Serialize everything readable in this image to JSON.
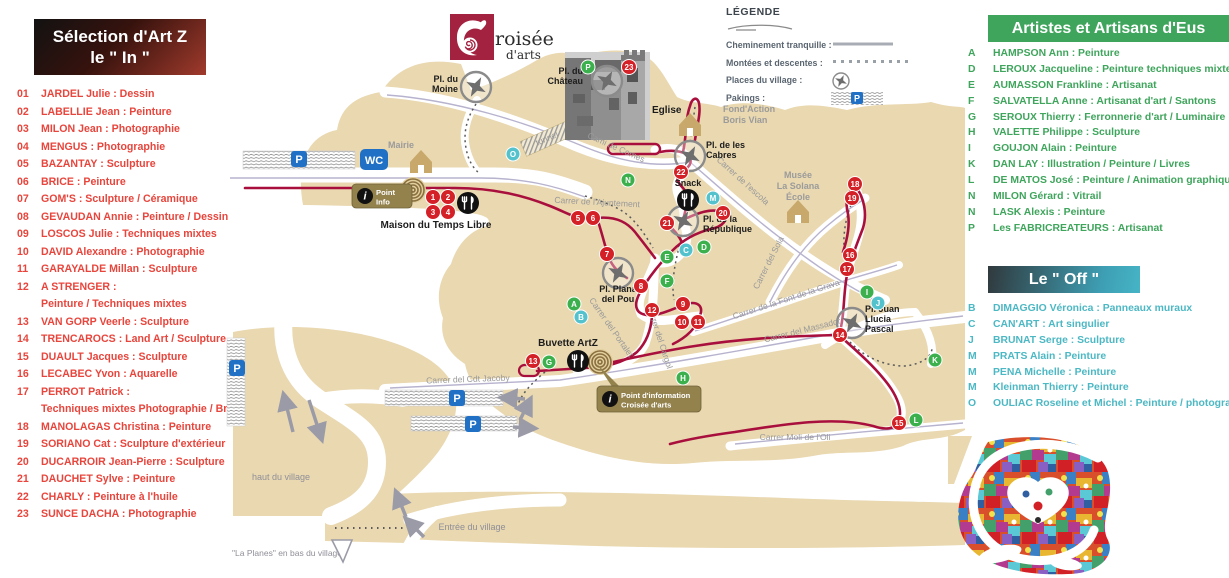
{
  "left_panel": {
    "title_line1": "Sélection d'Art Z",
    "title_line2": "le \" In \"",
    "items": [
      {
        "num": "01",
        "text": "JARDEL Julie : Dessin"
      },
      {
        "num": "02",
        "text": "LABELLIE Jean : Peinture"
      },
      {
        "num": "03",
        "text": "MILON Jean : Photographie"
      },
      {
        "num": "04",
        "text": "MENGUS :  Photographie"
      },
      {
        "num": "05",
        "text": "BAZANTAY : Sculpture"
      },
      {
        "num": "06",
        "text": "BRICE : Peinture"
      },
      {
        "num": "07",
        "text": "GOM'S : Sculpture / Céramique"
      },
      {
        "num": "08",
        "text": "GEVAUDAN Annie : Peinture / Dessin"
      },
      {
        "num": "09",
        "text": "LOSCOS Julie : Techniques mixtes"
      },
      {
        "num": "10",
        "text": "DAVID Alexandre : Photographie"
      },
      {
        "num": "11",
        "text": "GARAYALDE Millan : Sculpture"
      },
      {
        "num": "12",
        "text": "A STRENGER :",
        "text2": "Peinture / Techniques mixtes"
      },
      {
        "num": "13",
        "text": "VAN GORP Veerle : Sculpture"
      },
      {
        "num": "14",
        "text": "TRENCAROCS : Land Art / Sculpture"
      },
      {
        "num": "15",
        "text": "DUAULT Jacques : Sculpture"
      },
      {
        "num": "16",
        "text": "LECABEC Yvon : Aquarelle"
      },
      {
        "num": "17",
        "text": "PERROT Patrick :",
        "text2": "Techniques mixtes Photographie / Broderie"
      },
      {
        "num": "18",
        "text": "MANOLAGAS Christina : Peinture"
      },
      {
        "num": "19",
        "text": "SORIANO Cat : Sculpture d'extérieur"
      },
      {
        "num": "20",
        "text": "DUCARROIR Jean-Pierre : Sculpture"
      },
      {
        "num": "21",
        "text": "DAUCHET Sylve : Peinture"
      },
      {
        "num": "22",
        "text": "CHARLY : Peinture à l'huile"
      },
      {
        "num": "23",
        "text": "SUNCE DACHA : Photographie"
      }
    ]
  },
  "right_panel": {
    "eus_title": "Artistes et Artisans d'Eus",
    "eus_items": [
      {
        "letter": "A",
        "text": "HAMPSON Ann : Peinture"
      },
      {
        "letter": "D",
        "text": "LEROUX Jacqueline : Peinture techniques mixtes"
      },
      {
        "letter": "E",
        "text": "AUMASSON Frankline : Artisanat"
      },
      {
        "letter": "F",
        "text": "SALVATELLA Anne : Artisanat d'art / Santons"
      },
      {
        "letter": "G",
        "text": "SEROUX Thierry : Ferronnerie d'art / Luminaire"
      },
      {
        "letter": "H",
        "text": "VALETTE Philippe : Sculpture"
      },
      {
        "letter": "I",
        "text": "GOUJON Alain : Peinture"
      },
      {
        "letter": "K",
        "text": "DAN LAY : Illustration / Peinture / Livres"
      },
      {
        "letter": "L",
        "text": "DE MATOS José : Peinture / Animation graphique"
      },
      {
        "letter": "N",
        "text": "MILON Gérard : Vitrail"
      },
      {
        "letter": "N",
        "text": "LASK Alexis : Peinture"
      },
      {
        "letter": "P",
        "text": "Les FABRICREATEURS : Artisanat"
      }
    ],
    "off_title": "Le \" Off \"",
    "off_items": [
      {
        "letter": "B",
        "text": "DIMAGGIO Véronica : Panneaux muraux"
      },
      {
        "letter": "C",
        "text": "CAN'ART : Art singulier"
      },
      {
        "letter": "J",
        "text": "BRUNAT Serge : Sculpture"
      },
      {
        "letter": "M",
        "text": "PRATS Alain : Peinture"
      },
      {
        "letter": "M",
        "text": "PENA Michelle : Peinture"
      },
      {
        "letter": "M",
        "text": "Kleinman Thierry : Peinture"
      },
      {
        "letter": "O",
        "text": "OULIAC Roseline et Michel : Peinture / photographie"
      }
    ]
  },
  "legend": {
    "title": "LÉGENDE",
    "items": [
      {
        "label": "Cheminement tranquille :",
        "swatch": "line"
      },
      {
        "label": "Montées et descentes :",
        "swatch": "dots"
      },
      {
        "label": "Places du village :",
        "swatch": "compass"
      },
      {
        "label": "Pakings :",
        "swatch": "parking"
      }
    ]
  },
  "logo": {
    "text_top": "roisée",
    "text_bottom": "d'arts"
  },
  "map": {
    "wc_label": "WC",
    "p_label": "P",
    "badges": [
      {
        "x": 127,
        "y": 184,
        "w": 60,
        "h": 24,
        "lines": [
          "Point",
          "Info"
        ]
      },
      {
        "x": 372,
        "y": 386,
        "w": 104,
        "h": 26,
        "lines": [
          "Point d'information",
          "Croisée d'arts"
        ]
      }
    ],
    "numbered_markers": [
      [
        1,
        208,
        197
      ],
      [
        2,
        223,
        197
      ],
      [
        3,
        208,
        212
      ],
      [
        4,
        223,
        212
      ],
      [
        5,
        353,
        218
      ],
      [
        6,
        368,
        218
      ],
      [
        7,
        382,
        254
      ],
      [
        8,
        416,
        286
      ],
      [
        9,
        458,
        304
      ],
      [
        10,
        457,
        322
      ],
      [
        11,
        473,
        322
      ],
      [
        12,
        427,
        310
      ],
      [
        13,
        308,
        361
      ],
      [
        14,
        615,
        335
      ],
      [
        15,
        674,
        423
      ],
      [
        16,
        625,
        255
      ],
      [
        17,
        622,
        269
      ],
      [
        18,
        630,
        184
      ],
      [
        19,
        627,
        198
      ],
      [
        20,
        498,
        213
      ],
      [
        21,
        442,
        223
      ],
      [
        22,
        456,
        172
      ],
      [
        23,
        404,
        67
      ]
    ],
    "letter_markers_green": [
      [
        "A",
        349,
        304
      ],
      [
        "D",
        479,
        247
      ],
      [
        "E",
        442,
        257
      ],
      [
        "F",
        442,
        281
      ],
      [
        "G",
        324,
        362
      ],
      [
        "H",
        458,
        378
      ],
      [
        "I",
        642,
        292
      ],
      [
        "K",
        710,
        360
      ],
      [
        "L",
        691,
        420
      ],
      [
        "N",
        403,
        180
      ],
      [
        "P",
        363,
        67
      ]
    ],
    "letter_markers_teal": [
      [
        "B",
        356,
        317
      ],
      [
        "C",
        461,
        250
      ],
      [
        "J",
        653,
        303
      ],
      [
        "M",
        488,
        198
      ],
      [
        "O",
        288,
        154
      ]
    ],
    "compasses": [
      [
        251,
        87
      ],
      [
        382,
        81
      ],
      [
        465,
        156
      ],
      [
        458,
        221
      ],
      [
        393,
        273
      ],
      [
        627,
        323
      ]
    ],
    "houses": [
      [
        196,
        160
      ],
      [
        465,
        123
      ],
      [
        573,
        210
      ]
    ],
    "food_icons": [
      [
        243,
        203
      ],
      [
        463,
        200
      ],
      [
        353,
        361
      ]
    ],
    "spiral_icons": [
      [
        188,
        190
      ],
      [
        375,
        362
      ]
    ],
    "parking_strips": [
      {
        "x": 18,
        "y": 151,
        "w": 112,
        "h": 18,
        "px": 66,
        "py": 151
      },
      {
        "x": 2,
        "y": 338,
        "w": 18,
        "h": 88,
        "px": 4,
        "py": 360
      },
      {
        "x": 160,
        "y": 390,
        "w": 118,
        "h": 16,
        "px": 224,
        "py": 390
      },
      {
        "x": 186,
        "y": 416,
        "w": 106,
        "h": 15,
        "px": 240,
        "py": 416
      }
    ],
    "place_labels": [
      {
        "t": "Pl. du",
        "x": 233,
        "y": 82,
        "a": "end"
      },
      {
        "t": "Moine",
        "x": 233,
        "y": 92,
        "a": "end"
      },
      {
        "t": "Pl. du",
        "x": 358,
        "y": 74,
        "a": "end"
      },
      {
        "t": "Château",
        "x": 358,
        "y": 84,
        "a": "end"
      },
      {
        "t": "Eglise",
        "x": 427,
        "y": 113,
        "a": "start",
        "fs": 10
      },
      {
        "t": "Pl. de les",
        "x": 481,
        "y": 148
      },
      {
        "t": "Cabres",
        "x": 481,
        "y": 158
      },
      {
        "t": "Snack",
        "x": 463,
        "y": 186,
        "a": "middle"
      },
      {
        "t": "Pl. de la",
        "x": 478,
        "y": 222
      },
      {
        "t": "République",
        "x": 478,
        "y": 232
      },
      {
        "t": "Pl. Plana",
        "x": 393,
        "y": 292,
        "a": "middle"
      },
      {
        "t": "del Pou",
        "x": 393,
        "y": 302,
        "a": "middle"
      },
      {
        "t": "Pl. Juan",
        "x": 640,
        "y": 312
      },
      {
        "t": "Llucia",
        "x": 640,
        "y": 322
      },
      {
        "t": "Pascal",
        "x": 640,
        "y": 332
      },
      {
        "t": "Maison du Temps Libre",
        "x": 211,
        "y": 228,
        "a": "middle",
        "fs": 10
      },
      {
        "t": "Buvette ArtZ",
        "x": 343,
        "y": 346,
        "a": "middle",
        "fs": 10
      }
    ],
    "building_labels": [
      {
        "t": "Mairie",
        "x": 176,
        "y": 148,
        "a": "middle"
      },
      {
        "t": "Fond'Action",
        "x": 498,
        "y": 112
      },
      {
        "t": "Boris Vian",
        "x": 498,
        "y": 123
      },
      {
        "t": "Musée",
        "x": 573,
        "y": 178,
        "a": "middle"
      },
      {
        "t": "La Solana",
        "x": 573,
        "y": 189,
        "a": "middle"
      },
      {
        "t": "École",
        "x": 573,
        "y": 200,
        "a": "middle"
      }
    ],
    "street_labels": [
      {
        "t": "Cami de Comes",
        "x": 390,
        "y": 150,
        "r": 24
      },
      {
        "t": "Carrer de l'Ajuntement",
        "x": 372,
        "y": 205,
        "r": 3
      },
      {
        "t": "Carrer de l'escola",
        "x": 516,
        "y": 183,
        "r": 42
      },
      {
        "t": "Carrer del Sola",
        "x": 546,
        "y": 264,
        "r": -63
      },
      {
        "t": "Carrer de la Font de la Grava",
        "x": 562,
        "y": 302,
        "r": -18
      },
      {
        "t": "Carrer del Massador",
        "x": 578,
        "y": 333,
        "r": -14
      },
      {
        "t": "Carrer del Portalet",
        "x": 384,
        "y": 329,
        "r": 55
      },
      {
        "t": "Carrer del Cargol",
        "x": 432,
        "y": 338,
        "r": 72
      },
      {
        "t": "Carrer del Cdt Jacoby",
        "x": 243,
        "y": 382,
        "r": -2
      },
      {
        "t": "Carrer Moli de l'Oli",
        "x": 570,
        "y": 440,
        "r": 0
      },
      {
        "t": "tunnel",
        "x": 323,
        "y": 141,
        "r": -24
      }
    ],
    "direction_labels": [
      {
        "t": "haut du village",
        "x": 56,
        "y": 480,
        "a": "middle"
      },
      {
        "t": "Entrée du village",
        "x": 247,
        "y": 530,
        "a": "middle"
      },
      {
        "t": "\"La Planes\" en bas du village",
        "x": 62,
        "y": 556,
        "a": "middle",
        "fs": 8.5
      }
    ],
    "arrows": [
      [
        68,
        432,
        60,
        400
      ],
      [
        84,
        400,
        95,
        434
      ],
      [
        300,
        399,
        282,
        398
      ],
      [
        288,
        427,
        304,
        428
      ],
      [
        295,
        420,
        303,
        404
      ],
      [
        181,
        517,
        173,
        497
      ],
      [
        199,
        537,
        185,
        523
      ]
    ],
    "colors": {
      "tan": "#e9d8b0",
      "route_red": "#a90f3d",
      "marker_red": "#d42127",
      "marker_green": "#3bb04d",
      "marker_teal": "#53c2cd",
      "blue": "#2071c5",
      "khaki": "#94824d",
      "road_line": "#b7b2ce"
    }
  }
}
